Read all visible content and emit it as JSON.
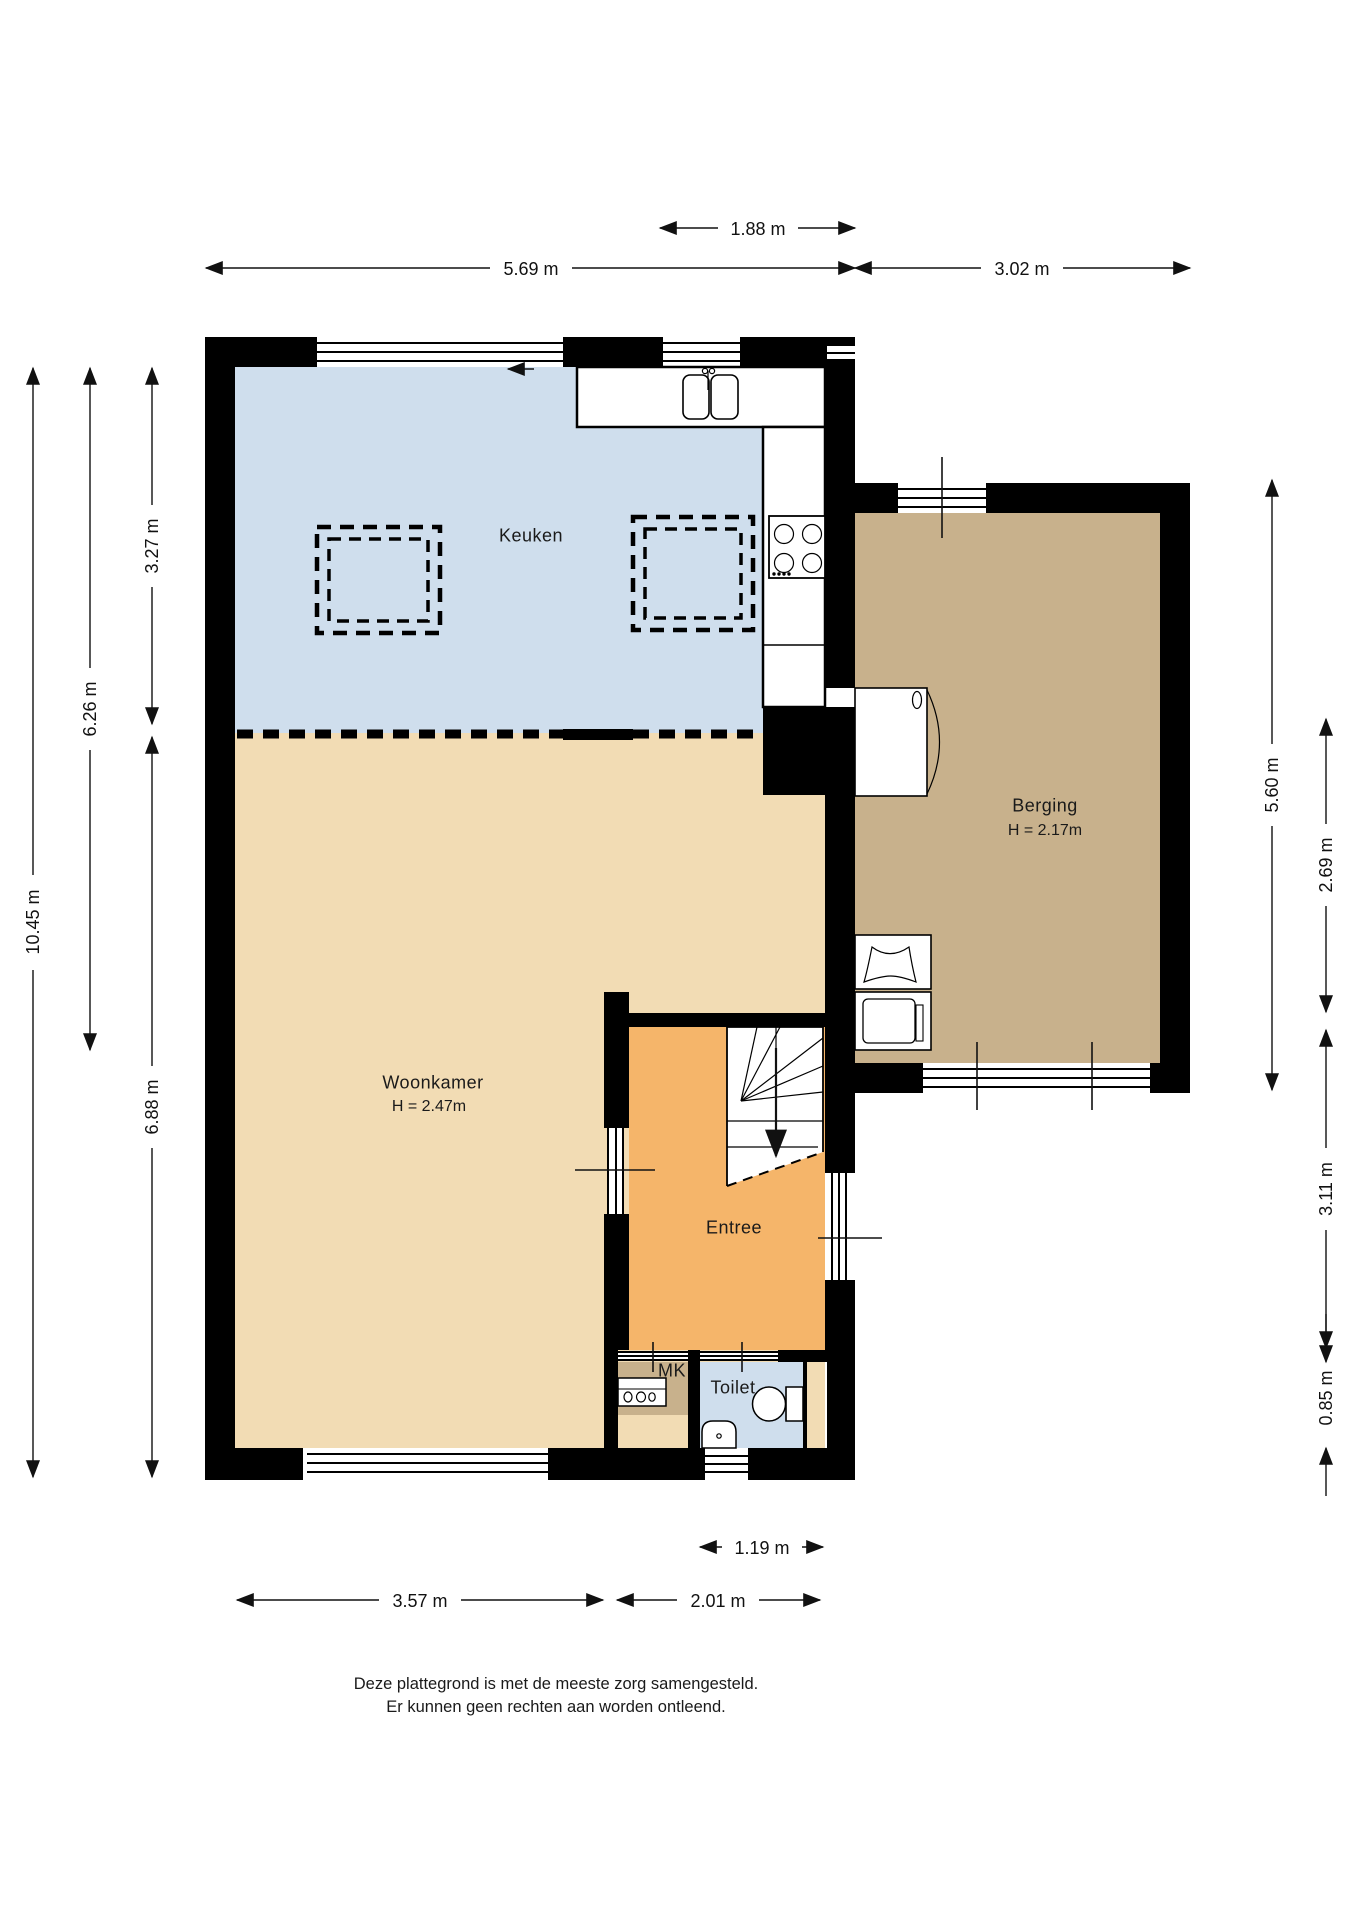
{
  "floorplan": {
    "colors": {
      "wall": "#000000",
      "kitchen_floor": "#cfdeed",
      "living_floor": "#f2dcb4",
      "entry_floor": "#f5b56a",
      "storage_floor": "#c8b18c",
      "toilet_floor": "#cfdeed",
      "mk_floor": "#c8b18c"
    },
    "rooms": {
      "keuken": {
        "label": "Keuken"
      },
      "woonkamer": {
        "label": "Woonkamer",
        "height": "H = 2.47m"
      },
      "berging": {
        "label": "Berging",
        "height": "H = 2.17m"
      },
      "entree": {
        "label": "Entree"
      },
      "mk": {
        "label": "MK"
      },
      "toilet": {
        "label": "Toilet"
      }
    },
    "dimensions": {
      "top_inner": "1.88 m",
      "top_left": "5.69 m",
      "top_right": "3.02 m",
      "left_total": "10.45 m",
      "left_upper": "6.26 m",
      "left_kitchen": "3.27 m",
      "left_living": "6.88 m",
      "right_storage": "5.60 m",
      "right_storage_inner": "2.69 m",
      "right_entry": "3.11 m",
      "right_toilet": "0.85 m",
      "bottom_toilet": "1.19 m",
      "bottom_left": "3.57 m",
      "bottom_right": "2.01 m"
    },
    "disclaimer": {
      "line1": "Deze plattegrond is met de meeste zorg samengesteld.",
      "line2": "Er kunnen geen rechten aan worden ontleend."
    }
  }
}
